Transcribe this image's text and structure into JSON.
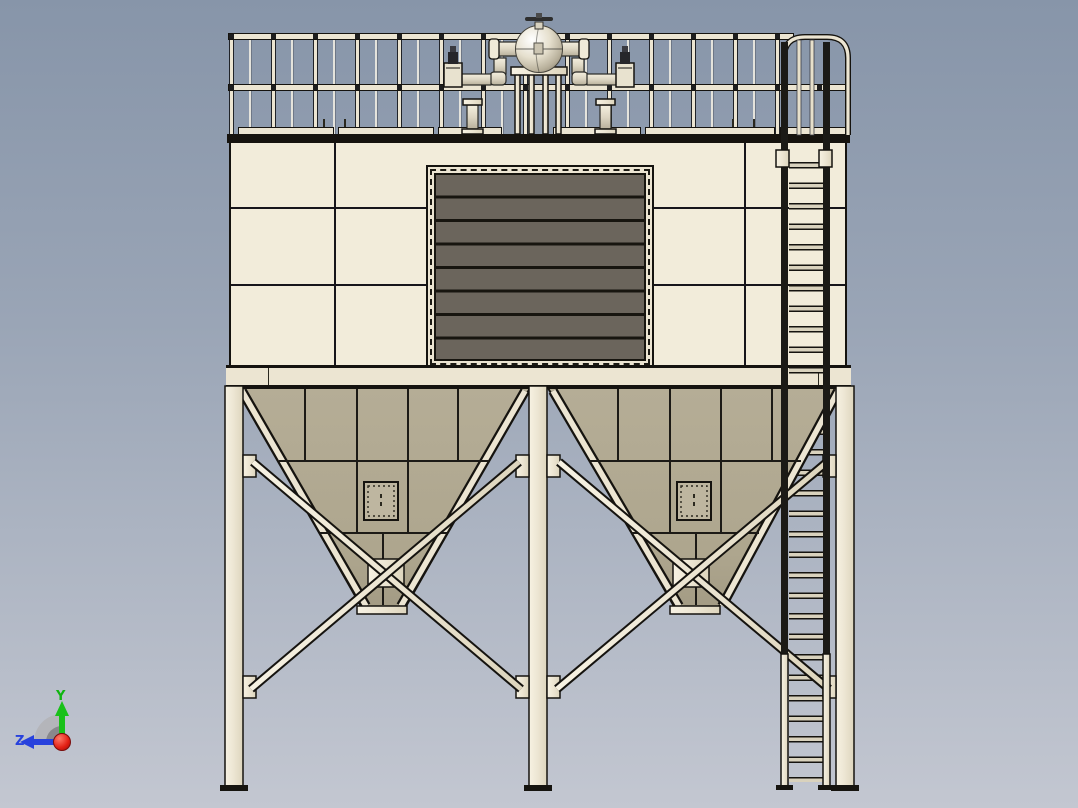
{
  "scene": {
    "description": "3D CAD viewport, front orthographic view of a baghouse dust collector",
    "background_top": "#8795a9",
    "background_bottom": "#c3c7d1"
  },
  "colors": {
    "panel_cream": "#f2ecda",
    "structure_cream": "#ece5d2",
    "hopper_tan": "#b2aa93",
    "louver_gray": "#6b655c",
    "band_dark": "#16130e",
    "background_top": "#8795a9",
    "background_bottom": "#c3c7d1"
  },
  "axis_triad": {
    "y_label": "Y",
    "z_label": "Z",
    "y_color": "#0fb50f",
    "z_color": "#2741dd",
    "origin_ball_color": "#d91111"
  },
  "components": {
    "handrail": "perimeter guard railing",
    "air_tank": "spherical compressed-air header with top valve",
    "pulse_valves": {
      "count": 2
    },
    "pipe_stubs": {
      "count": 2
    },
    "louver_door": {
      "label": "louvered access door",
      "slats": 8
    },
    "hoppers": {
      "count": 2,
      "access_doors": 2
    },
    "support_legs": {
      "count": 4
    },
    "cross_bracing": "X-bracing between legs",
    "ladder": "caged side access ladder"
  }
}
